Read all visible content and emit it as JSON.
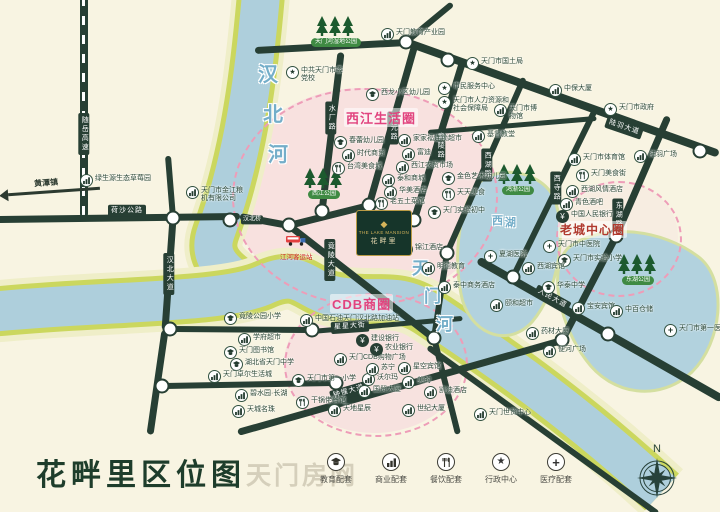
{
  "title": "花畔里区位图",
  "watermark": "天门房网",
  "compass_label": "N",
  "project": {
    "name_en": "THE LAKE MANSION",
    "name": "花畔里"
  },
  "legend": {
    "items": [
      {
        "icon": "education-icon",
        "label": "教育配套"
      },
      {
        "icon": "business-icon",
        "label": "商业配套"
      },
      {
        "icon": "dining-icon",
        "label": "餐饮配套"
      },
      {
        "icon": "government-icon",
        "label": "行政中心"
      },
      {
        "icon": "medical-icon",
        "label": "医疗配套"
      }
    ]
  },
  "colors": {
    "road": "#273f34",
    "water": "#aecfdc",
    "river_bank": "#cbd75e",
    "accent_pink": "#e1447f",
    "oldtown_red": "#b03a2e",
    "park_green": "#3f8a43",
    "gold": "#c2a24b",
    "logo_bg": "#16352a",
    "title_green": "#1e3d2b"
  },
  "map": {
    "rivers": [
      {
        "name": "汉北河",
        "d": "M263,-30 C256,60 246,150 216,232 C208,254 218,268 246,286",
        "widths": [
          58,
          48,
          38
        ]
      },
      {
        "name": "天门河",
        "d": "M-10,312 C110,300 225,304 266,284 C302,268 306,292 338,297 C378,303 398,292 428,312 C470,340 560,398 662,492",
        "widths": [
          62,
          50,
          40
        ]
      }
    ],
    "lakes": [
      {
        "name": "西湖",
        "d": "M472,192 C488,162 540,168 554,198 C568,232 558,292 532,322 C506,350 468,332 461,294 C454,258 458,218 472,192 Z"
      },
      {
        "name": "东湖",
        "d": "M568,248 C602,222 662,228 700,258 C728,282 722,342 692,372 C660,402 612,396 586,360 C562,328 546,272 568,248 Z"
      }
    ],
    "river_labels": [
      {
        "chars": [
          "汉",
          "北",
          "河"
        ],
        "x": 258,
        "y": 58,
        "dx": 5,
        "dy": 40,
        "fs": 20
      },
      {
        "chars": [
          "天",
          "门",
          "河"
        ],
        "x": 412,
        "y": 254,
        "dx": 12,
        "dy": 28,
        "fs": 17
      },
      {
        "chars": [
          "西",
          "湖"
        ],
        "x": 492,
        "y": 212,
        "dx": 13,
        "dy": 2,
        "fs": 11
      }
    ],
    "zones": [
      {
        "label": "西江生活圈",
        "x": 232,
        "y": 88,
        "w": 262,
        "h": 214,
        "label_x": 344,
        "label_y": 108,
        "fill": "rgba(247,205,219,0.5)",
        "color": "#e1447f",
        "fs": 13
      },
      {
        "label": "CDB商圈",
        "x": 284,
        "y": 293,
        "w": 180,
        "h": 140,
        "label_x": 330,
        "label_y": 294,
        "fill": "rgba(247,205,219,0.45)",
        "color": "#e1447f",
        "fs": 13
      },
      {
        "label": "老城中心圈",
        "x": 556,
        "y": 181,
        "w": 122,
        "h": 112,
        "label_x": 558,
        "label_y": 221,
        "fill": "rgba(247,215,225,0.22)",
        "color": "#b03a2e",
        "fs": 12
      }
    ],
    "road_segments": [
      [
        84,
        -5,
        84,
        218,
        8,
        "hwy"
      ],
      [
        -5,
        219,
        240,
        216,
        7
      ],
      [
        168,
        156,
        173,
        218,
        6
      ],
      [
        173,
        218,
        165,
        330,
        7
      ],
      [
        165,
        330,
        150,
        434,
        7
      ],
      [
        170,
        329,
        312,
        330,
        6
      ],
      [
        162,
        386,
        336,
        383,
        6
      ],
      [
        240,
        216,
        289,
        225,
        7
      ],
      [
        289,
        225,
        369,
        205,
        7
      ],
      [
        289,
        225,
        434,
        338,
        7
      ],
      [
        341,
        52,
        322,
        211,
        7
      ],
      [
        415,
        44,
        369,
        205,
        7
      ],
      [
        463,
        60,
        414,
        220,
        7
      ],
      [
        524,
        78,
        447,
        253,
        6
      ],
      [
        447,
        253,
        434,
        338,
        6
      ],
      [
        596,
        108,
        513,
        277,
        6
      ],
      [
        668,
        116,
        616,
        236,
        7
      ],
      [
        616,
        236,
        562,
        340,
        7
      ],
      [
        255,
        50,
        406,
        42,
        7
      ],
      [
        406,
        42,
        452,
        4,
        6
      ],
      [
        406,
        42,
        719,
        154,
        8
      ],
      [
        428,
        132,
        596,
        118,
        5
      ],
      [
        478,
        260,
        722,
        399,
        8
      ],
      [
        238,
        432,
        562,
        340,
        7
      ],
      [
        312,
        331,
        462,
        318,
        5
      ],
      [
        434,
        338,
        458,
        434,
        6
      ],
      [
        428,
        347,
        658,
        514,
        6
      ]
    ],
    "junctions": [
      [
        406,
        42
      ],
      [
        448,
        60
      ],
      [
        700,
        151
      ],
      [
        173,
        218
      ],
      [
        230,
        220
      ],
      [
        289,
        225
      ],
      [
        322,
        211
      ],
      [
        369,
        205
      ],
      [
        414,
        220
      ],
      [
        616,
        236
      ],
      [
        513,
        277
      ],
      [
        434,
        338
      ],
      [
        312,
        330
      ],
      [
        170,
        329
      ],
      [
        162,
        386
      ],
      [
        336,
        383
      ],
      [
        562,
        340
      ],
      [
        608,
        334
      ],
      [
        447,
        253
      ]
    ],
    "road_labels": [
      {
        "text": "随岳高速",
        "x": 84,
        "y": 134,
        "vert": true
      },
      {
        "text": "荷沙公路",
        "x": 127,
        "y": 211
      },
      {
        "text": "汉北桥",
        "x": 252,
        "y": 220,
        "small": true
      },
      {
        "text": "汉北大道",
        "x": 169,
        "y": 274,
        "vert": true
      },
      {
        "text": "竟陵大道",
        "x": 330,
        "y": 260,
        "vert": true
      },
      {
        "text": "水厂路",
        "x": 331,
        "y": 118,
        "vert": true
      },
      {
        "text": "状元路",
        "x": 393,
        "y": 128,
        "vert": true
      },
      {
        "text": "竟陵路",
        "x": 440,
        "y": 146,
        "vert": true
      },
      {
        "text": "西湖路",
        "x": 487,
        "y": 165,
        "vert": true
      },
      {
        "text": "西寺路",
        "x": 556,
        "y": 188,
        "vert": true
      },
      {
        "text": "东湖路",
        "x": 618,
        "y": 215,
        "vert": true
      },
      {
        "text": "陆羽大道",
        "x": 624,
        "y": 128,
        "rot": 19
      },
      {
        "text": "人民大道",
        "x": 552,
        "y": 299,
        "rot": 29
      },
      {
        "text": "钟惺大道",
        "x": 349,
        "y": 392,
        "rot": -16
      },
      {
        "text": "星星大街",
        "x": 350,
        "y": 327,
        "rot": -4
      }
    ],
    "arrow": {
      "label": "黄潭镇",
      "x": 8,
      "y": 176
    },
    "parks": [
      {
        "label": "天门河湿地公园",
        "x": 316,
        "y": 16
      },
      {
        "label": "西江公园",
        "x": 304,
        "y": 168
      },
      {
        "label": "鸿渐公园",
        "x": 498,
        "y": 164
      },
      {
        "label": "东湖公园",
        "x": 618,
        "y": 254
      }
    ],
    "transit_station": {
      "label": "江河客运站",
      "x": 280,
      "y": 233
    },
    "pois": [
      {
        "icon": "shop",
        "label": "绿生源生态草莓园",
        "x": 80,
        "y": 174
      },
      {
        "icon": "shop",
        "label": "天门市金江粮机有限公司",
        "x": 186,
        "y": 186,
        "w": 48
      },
      {
        "icon": "star",
        "label": "中共天门市委党校",
        "x": 286,
        "y": 66,
        "w": 42
      },
      {
        "icon": "shop",
        "label": "天门教育产业园",
        "x": 381,
        "y": 28
      },
      {
        "icon": "star",
        "label": "天门市国土局",
        "x": 466,
        "y": 57
      },
      {
        "icon": "star",
        "label": "市民服务中心",
        "x": 438,
        "y": 82
      },
      {
        "icon": "star",
        "label": "天门市人力资源和社会保障局",
        "x": 438,
        "y": 96,
        "w": 58
      },
      {
        "icon": "shop",
        "label": "中保大厦",
        "x": 549,
        "y": 84
      },
      {
        "icon": "star",
        "label": "天门市政府",
        "x": 604,
        "y": 103
      },
      {
        "icon": "shop",
        "label": "天门市博物馆",
        "x": 494,
        "y": 104,
        "w": 32
      },
      {
        "icon": "shop",
        "label": "基督教堂",
        "x": 472,
        "y": 130
      },
      {
        "icon": "edu",
        "label": "西龙小区幼儿园",
        "x": 366,
        "y": 88
      },
      {
        "icon": "edu",
        "label": "春蕾幼儿园",
        "x": 334,
        "y": 136
      },
      {
        "icon": "shop",
        "label": "时代商贸",
        "x": 342,
        "y": 149
      },
      {
        "icon": "food",
        "label": "台湾美食城",
        "x": 332,
        "y": 162
      },
      {
        "icon": "shop",
        "label": "家家福连锁超市",
        "x": 398,
        "y": 134
      },
      {
        "icon": "shop",
        "label": "富迪",
        "x": 402,
        "y": 148
      },
      {
        "icon": "shop",
        "label": "西江农贸市场",
        "x": 396,
        "y": 161
      },
      {
        "icon": "shop",
        "label": "泰和商城",
        "x": 382,
        "y": 174
      },
      {
        "icon": "shop",
        "label": "华美酒店",
        "x": 384,
        "y": 186
      },
      {
        "icon": "food",
        "label": "老五土菜馆",
        "x": 375,
        "y": 197
      },
      {
        "icon": "edu",
        "label": "金色艺术幼儿园",
        "x": 442,
        "y": 172
      },
      {
        "icon": "food",
        "label": "天天美食",
        "x": 442,
        "y": 188
      },
      {
        "icon": "edu",
        "label": "天门实验初中",
        "x": 428,
        "y": 206
      },
      {
        "icon": "shop",
        "label": "锦江酒店",
        "x": 400,
        "y": 243
      },
      {
        "icon": "shop",
        "label": "明德教育",
        "x": 422,
        "y": 262
      },
      {
        "icon": "shop",
        "label": "天门市体育馆",
        "x": 568,
        "y": 153
      },
      {
        "icon": "shop",
        "label": "陆羽广场",
        "x": 634,
        "y": 150
      },
      {
        "icon": "food",
        "label": "天门美食街",
        "x": 576,
        "y": 169
      },
      {
        "icon": "shop",
        "label": "西湖风情酒店",
        "x": 566,
        "y": 185
      },
      {
        "icon": "shop",
        "label": "青色酒吧",
        "x": 560,
        "y": 198
      },
      {
        "icon": "bank",
        "label": "中国人民银行",
        "x": 556,
        "y": 210
      },
      {
        "icon": "med",
        "label": "天门市中医院",
        "x": 543,
        "y": 240
      },
      {
        "icon": "edu",
        "label": "天门市实验小学",
        "x": 558,
        "y": 254
      },
      {
        "icon": "shop",
        "label": "西湖宾馆",
        "x": 522,
        "y": 262
      },
      {
        "icon": "med",
        "label": "夏湖医院",
        "x": 484,
        "y": 250
      },
      {
        "icon": "edu",
        "label": "华泰中学",
        "x": 542,
        "y": 281
      },
      {
        "icon": "shop",
        "label": "宝安宾馆",
        "x": 572,
        "y": 302
      },
      {
        "icon": "shop",
        "label": "中百仓储",
        "x": 610,
        "y": 305
      },
      {
        "icon": "med",
        "label": "天门市第一医院",
        "x": 664,
        "y": 324,
        "w": 50
      },
      {
        "icon": "shop",
        "label": "药材大厦",
        "x": 526,
        "y": 327
      },
      {
        "icon": "shop",
        "label": "便河广场",
        "x": 543,
        "y": 345
      },
      {
        "icon": "shop",
        "label": "颐和超市",
        "x": 490,
        "y": 299
      },
      {
        "icon": "shop",
        "label": "泰中商务酒店",
        "x": 438,
        "y": 281
      },
      {
        "icon": "shop",
        "label": "星空宾馆",
        "x": 398,
        "y": 362
      },
      {
        "icon": "shop",
        "label": "美的",
        "x": 402,
        "y": 376
      },
      {
        "icon": "shop",
        "label": "凯迪酒店",
        "x": 424,
        "y": 386
      },
      {
        "icon": "shop",
        "label": "世纪大厦",
        "x": 402,
        "y": 404
      },
      {
        "icon": "shop",
        "label": "天门世贸中心",
        "x": 474,
        "y": 408
      },
      {
        "icon": "shop",
        "label": "天地星辰",
        "x": 328,
        "y": 404
      },
      {
        "icon": "food",
        "label": "干锅佬餐馆",
        "x": 296,
        "y": 396
      },
      {
        "icon": "edu",
        "label": "天门市第一小学",
        "x": 292,
        "y": 374
      },
      {
        "icon": "shop",
        "label": "国贸大厦",
        "x": 358,
        "y": 385
      },
      {
        "icon": "shop",
        "label": "沃尔玛",
        "x": 362,
        "y": 373
      },
      {
        "icon": "shop",
        "label": "苏宁",
        "x": 366,
        "y": 363
      },
      {
        "icon": "shop",
        "label": "天门CDB购物广场",
        "x": 334,
        "y": 353
      },
      {
        "icon": "bank",
        "label": "农业银行",
        "x": 370,
        "y": 343
      },
      {
        "icon": "bank",
        "label": "建设银行",
        "x": 356,
        "y": 334
      },
      {
        "icon": "shop",
        "label": "中国石油天门汉北路加油站",
        "x": 300,
        "y": 314
      },
      {
        "icon": "edu",
        "label": "竟陵公园小学",
        "x": 224,
        "y": 312
      },
      {
        "icon": "shop",
        "label": "学府超市",
        "x": 238,
        "y": 333
      },
      {
        "icon": "edu",
        "label": "天门图书馆",
        "x": 224,
        "y": 346
      },
      {
        "icon": "edu",
        "label": "湖北省天门中学",
        "x": 230,
        "y": 358
      },
      {
        "icon": "shop",
        "label": "天门卓尔生活城",
        "x": 208,
        "y": 370
      },
      {
        "icon": "shop",
        "label": "碧水园·长湖",
        "x": 235,
        "y": 389
      },
      {
        "icon": "shop",
        "label": "天城名珠",
        "x": 232,
        "y": 405
      }
    ]
  }
}
